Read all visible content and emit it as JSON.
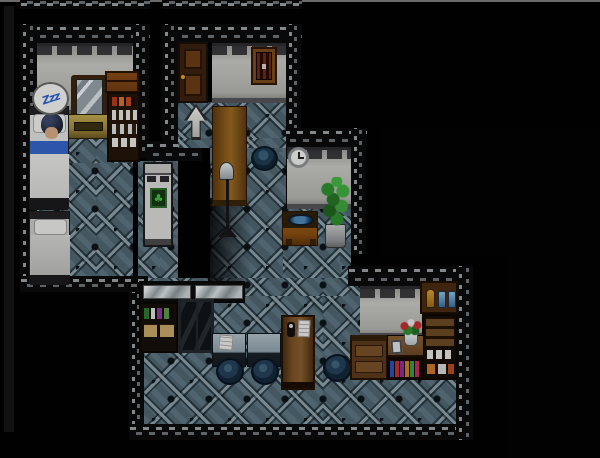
{
  "app": {
    "name": "RPG Maker style game",
    "view": "night-dimmed apartment interior map",
    "hud_text": "none"
  },
  "speech": {
    "sleep_bubble": "Zzz"
  },
  "colors": {
    "floor-tile": "#566f7c",
    "wall": "#c9c9c5",
    "wood": "#8a5a1a",
    "bubble-ink": "#2b5fd0",
    "blanket-blue": "#3565c8",
    "plant-green": "#2f8f2f",
    "stool-navy": "#24415a",
    "girder-dash": "#9aa0a4"
  },
  "rooms": [
    {
      "name": "bedroom",
      "items": [
        "occupied-bed",
        "sleeping-character",
        "sleep-bubble",
        "empty-bed",
        "vanity-mirror",
        "dresser",
        "wooden-chest",
        "supply-shelf"
      ]
    },
    {
      "name": "entry-hall",
      "items": [
        "wooden-door",
        "framed-window",
        "up-arrow-sign",
        "long-table",
        "floor-lamp",
        "cooking-pot"
      ]
    },
    {
      "name": "alcove",
      "items": [
        "refrigerator"
      ]
    },
    {
      "name": "washroom",
      "items": [
        "wall-clock",
        "wash-basin",
        "potted-plant"
      ]
    },
    {
      "name": "kitchen",
      "items": [
        "steel-counter",
        "book-hutch",
        "glass-cabinet",
        "table-with-paper",
        "table",
        "stool",
        "stool",
        "stool",
        "message-board"
      ]
    },
    {
      "name": "pantry",
      "items": [
        "jar-shelf",
        "dish-shelf",
        "sideboard",
        "flower-counter",
        "bookshelf"
      ]
    }
  ]
}
